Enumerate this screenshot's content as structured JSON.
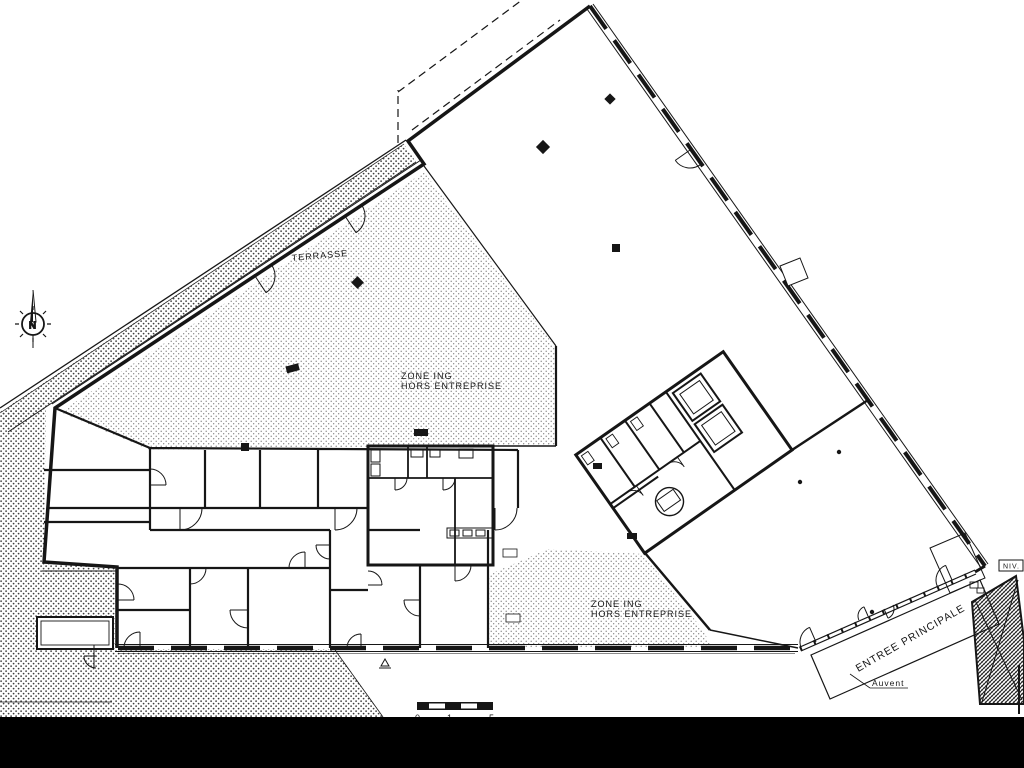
{
  "page": {
    "background": "#ffffff",
    "ink": "#161616",
    "band_color": "#000000"
  },
  "labels": {
    "terrasse": "TERRASSE",
    "zone_upper": {
      "line1": "ZONE ING",
      "line2": "HORS ENTREPRISE"
    },
    "zone_lower": {
      "line1": "ZONE ING",
      "line2": "HORS ENTREPRISE"
    },
    "entree": "ENTREE PRINCIPALE",
    "auvent": "Auvent",
    "niveau": "NIV.",
    "north": "N",
    "scale_ticks": {
      "t0": "0",
      "t1": "1",
      "t2": "5"
    }
  }
}
